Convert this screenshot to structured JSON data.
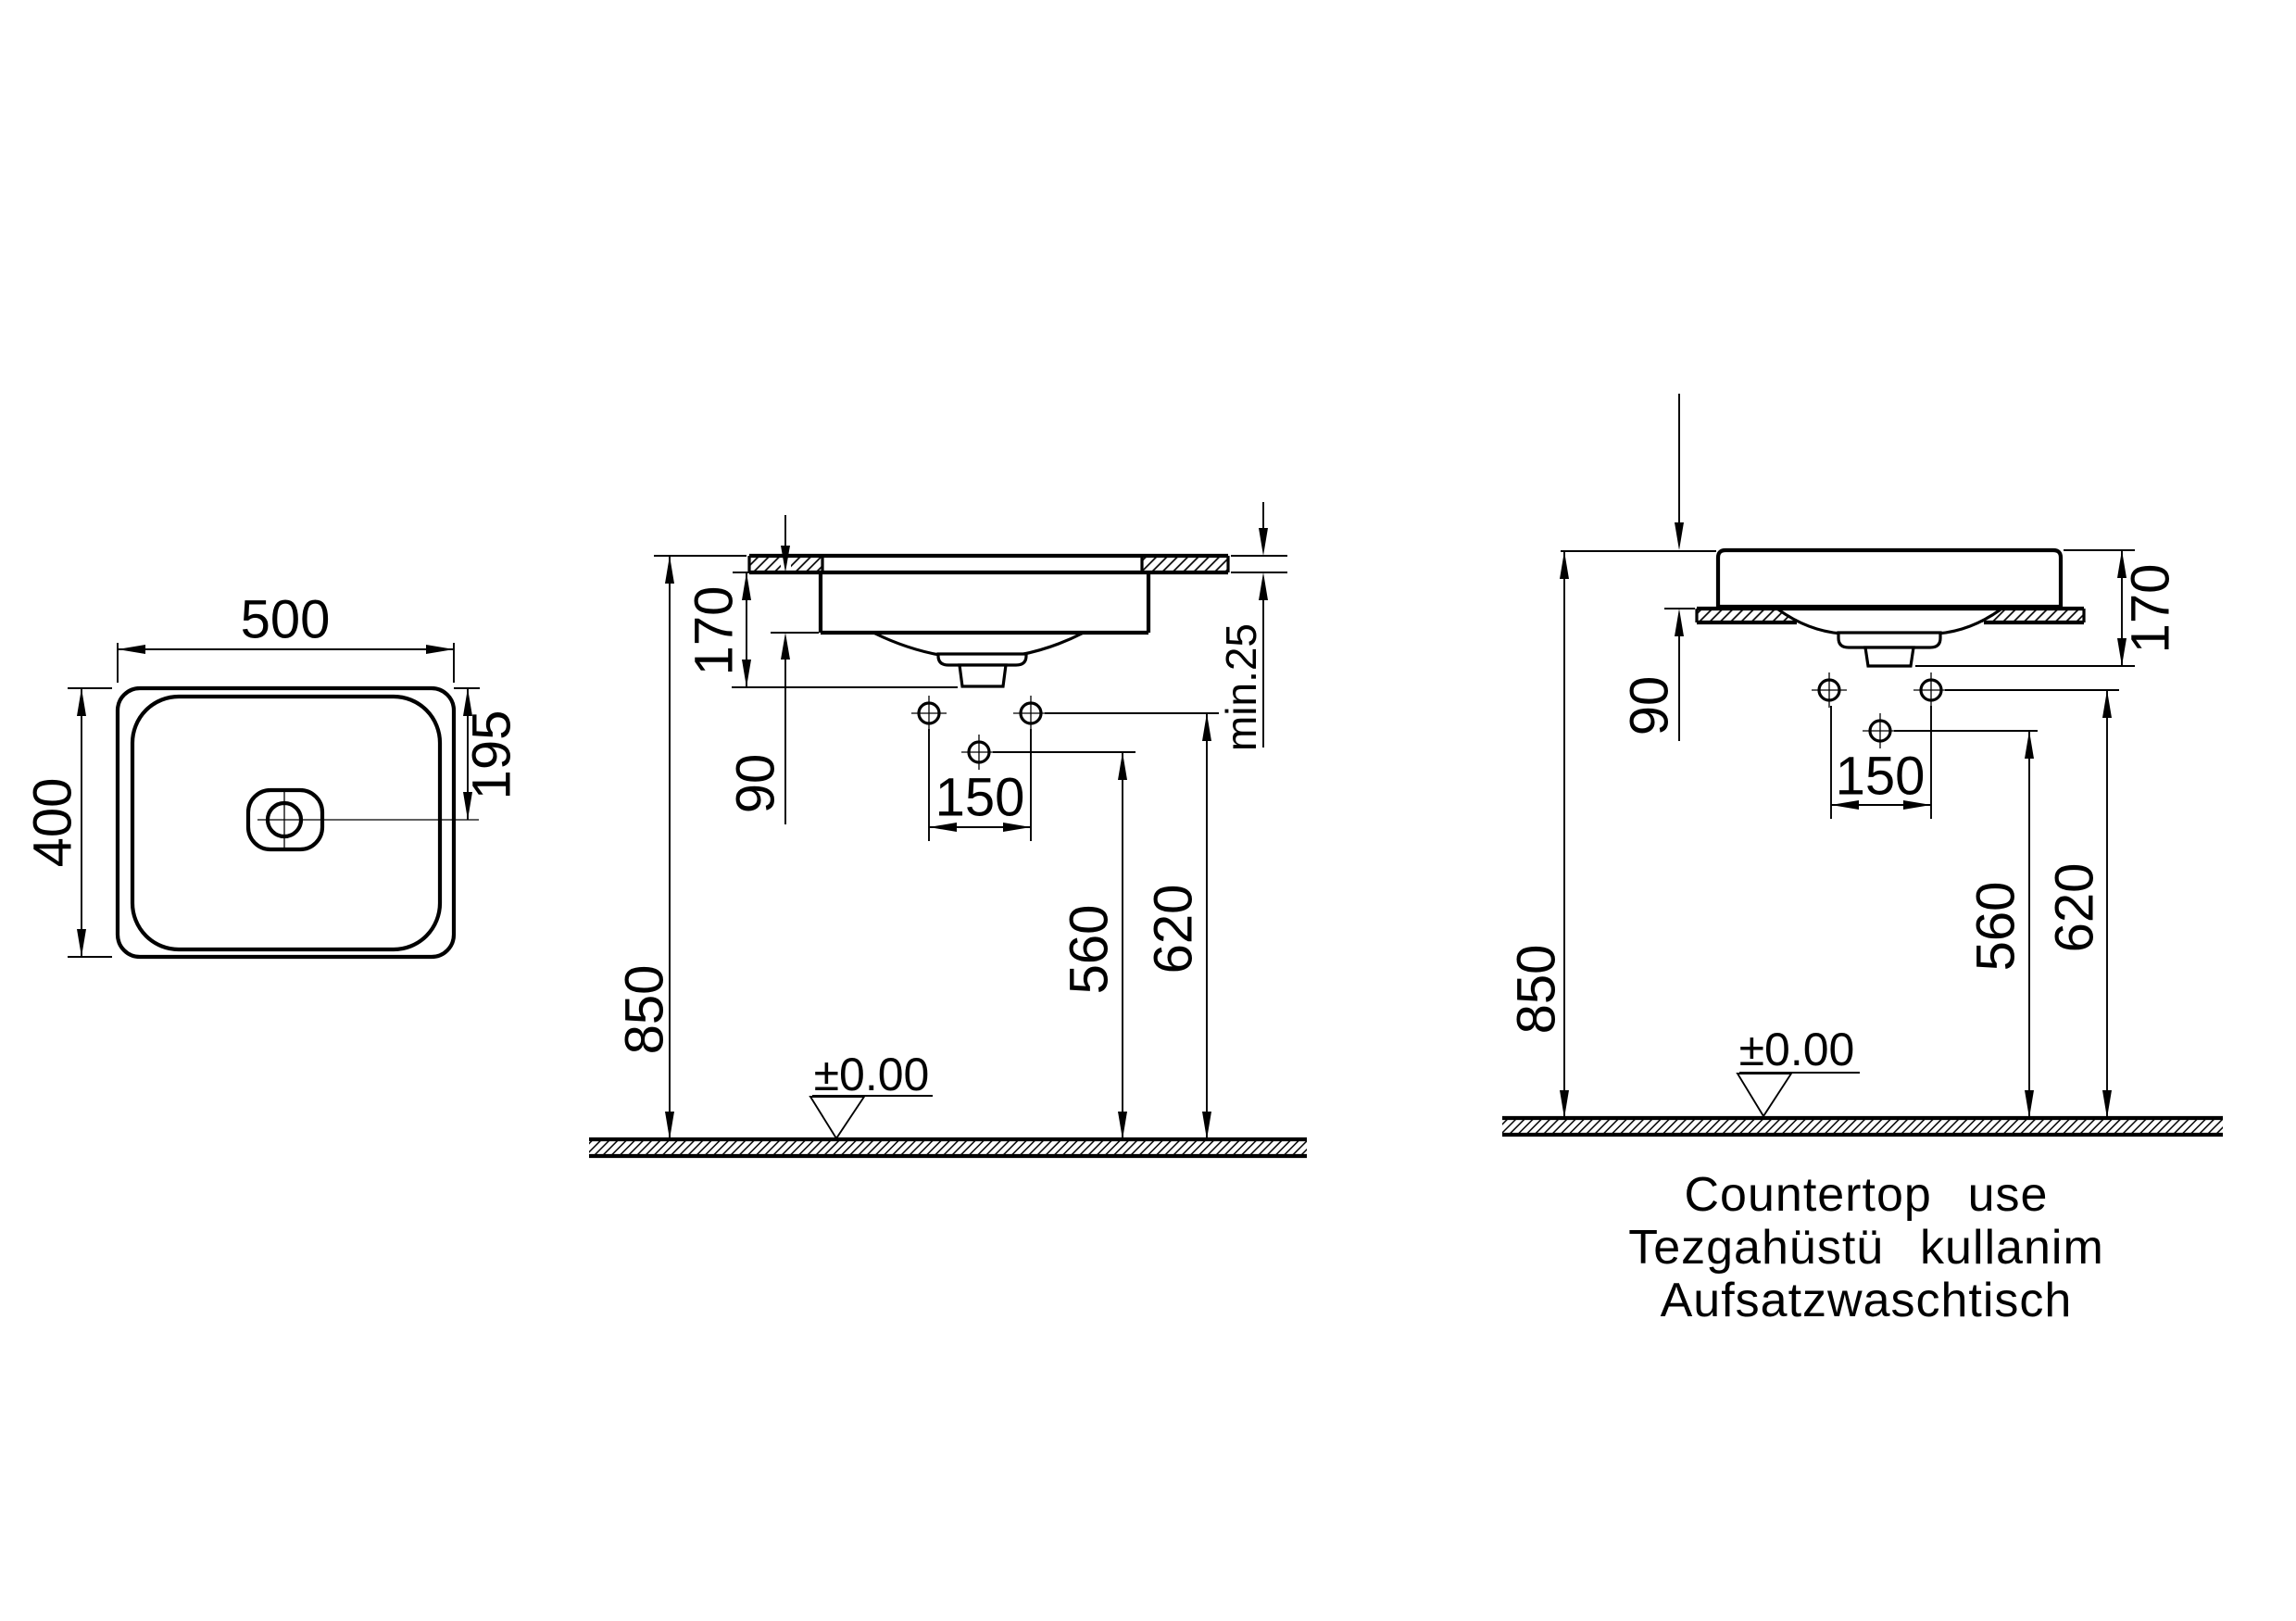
{
  "drawing": {
    "colors": {
      "line": "#000000",
      "background": "#ffffff"
    },
    "top_view": {
      "width": "500",
      "depth": "400",
      "drain_offset": "195"
    },
    "recessed_section": {
      "basin_height": "170",
      "depth_below_counter": "90",
      "tap_hole_spacing": "150",
      "drain_outlet_height": "560",
      "tap_hole_height": "620",
      "rim_height": "850",
      "countertop_thickness": "min.25",
      "floor_level": "±0.00"
    },
    "countertop_section": {
      "rim_height": "850",
      "height_above_counter": "90",
      "tap_hole_spacing": "150",
      "basin_height": "170",
      "drain_outlet_height": "560",
      "tap_hole_height": "620",
      "floor_level": "±0.00",
      "caption_line1": "Countertop use",
      "caption_line2": "Tezgahüstü kullanim",
      "caption_line3": "Aufsatzwaschtisch"
    }
  }
}
